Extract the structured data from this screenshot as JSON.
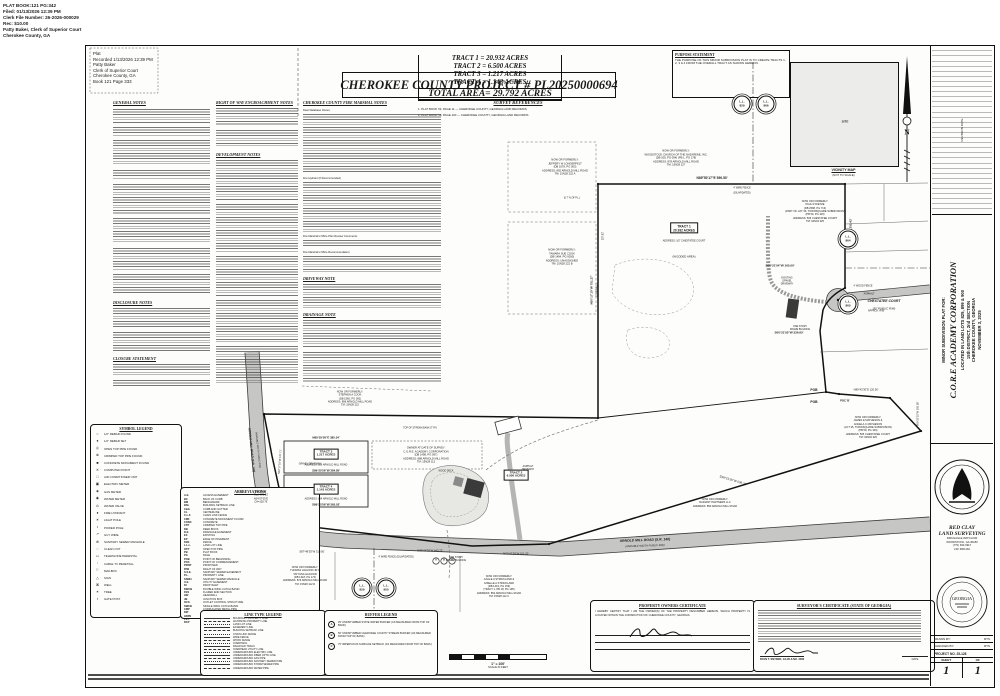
{
  "stamp": {
    "lines": [
      "PLAT BOOK:121  PG:342",
      "Filed: 01/13/2026 12:39 PM",
      "Clerk File Number: 26-2026-000029",
      "Rec: $10.00",
      "Patty Baker, Clerk of Superior Court",
      "Cherokee County, GA"
    ]
  },
  "recorded": {
    "lines": [
      "Plat",
      "Recorded 1/13/2026 12:39 PM",
      "Patty Baker",
      "Clerk of Superior Court",
      "Cherokee County, GA",
      "Book 121 Page 333"
    ]
  },
  "title": "CHEROKEE COUNTY PROJECT # PL20250000694",
  "survey_references": {
    "header": "SURVEY REFERENCES",
    "items": [
      "1.  PLAT BOOK 53, PAGE 11 — CHEROKEE COUNTY, GEORGIA LAND RECORDS",
      "2.  PLAT BOOK 59, PAGE 100 — CHEROKEE COUNTY, GEORGIA LAND RECORDS"
    ]
  },
  "tract_table": {
    "rows": [
      "TRACT 1 =   20.932 ACRES",
      "TRACT 2 =   6.500 ACRES",
      "TRACT 3 =   1.217 ACRES",
      "TRACT 4 =   1.143 ACRES"
    ],
    "total": "TOTAL AREA= 29.792 ACRES"
  },
  "purpose": {
    "header": "PURPOSE STATEMENT",
    "text": "THE PURPOSE OF THIS MINOR SUBDIVISION PLAT IS TO CREATE TRACTS 1, 2, 3 & 4 FROM THE OVERALL TRACT AS SHOWN HEREON."
  },
  "vicinity": {
    "caption": "VICINITY MAP",
    "subcaption": "(NOT TO SCALE)",
    "site_label": "SITE"
  },
  "north_label": "N",
  "notes": {
    "left_col_headers": [
      "GENERAL NOTES",
      "DISCLOSURE NOTES",
      "CLOSURE STATEMENT"
    ],
    "col1_headers": [
      "RIGHT OF WAY ENCROACHMENT NOTES",
      "DEVELOPMENT NOTES"
    ],
    "col2_headers": [
      "CHEROKEE COUNTY FIRE MARSHAL NOTES",
      "DRIVEWAY NOTE",
      "DRAINAGE NOTE"
    ],
    "col2_subheads": [
      "Dear Database Owner,",
      "Fire Hydrant (If Recommended)",
      "Fire Marshal's Office Plan Review Comments:",
      "Fire Marshal's Office Recommendation:"
    ]
  },
  "symbol_legend": {
    "header": "SYMBOL LEGEND",
    "items": [
      {
        "sym": "○",
        "label": "1/2\" REBAR FOUND"
      },
      {
        "sym": "●",
        "label": "1/2\" REBAR SET"
      },
      {
        "sym": "◎",
        "label": "OPEN TOP PIPE FOUND"
      },
      {
        "sym": "⊗",
        "label": "CRIMPED TOP PIPE FOUND"
      },
      {
        "sym": "■",
        "label": "CONCRETE MONUMENT FOUND"
      },
      {
        "sym": "✕",
        "label": "COMPUTED POINT"
      },
      {
        "sym": "□",
        "label": "AIR CONDITIONER UNIT"
      },
      {
        "sym": "▣",
        "label": "ELECTRIC METER"
      },
      {
        "sym": "◈",
        "label": "GAS METER"
      },
      {
        "sym": "◉",
        "label": "WATER METER"
      },
      {
        "sym": "⊙",
        "label": "WATER VALVE"
      },
      {
        "sym": "♦",
        "label": "FIRE HYDRANT"
      },
      {
        "sym": "☀",
        "label": "LIGHT POLE"
      },
      {
        "sym": "•",
        "label": "POWER POLE"
      },
      {
        "sym": "↗",
        "label": "GUY WIRE"
      },
      {
        "sym": "⊕",
        "label": "SANITARY SEWER MANHOLE"
      },
      {
        "sym": "◌",
        "label": "CLEAN OUT"
      },
      {
        "sym": "▭",
        "label": "TELEPHONE PEDESTAL"
      },
      {
        "sym": "▫",
        "label": "CABLE TV PEDESTAL"
      },
      {
        "sym": "⚐",
        "label": "MAILBOX"
      },
      {
        "sym": "△",
        "label": "SIGN"
      },
      {
        "sym": "⌘",
        "label": "WELL"
      },
      {
        "sym": "✶",
        "label": "TREE"
      },
      {
        "sym": "▪",
        "label": "GATE POST"
      }
    ]
  },
  "abbreviations": {
    "header": "ABBREVIATIONS",
    "items": [
      {
        "k": "A.E.",
        "v": "ACCESS EASEMENT"
      },
      {
        "k": "BC",
        "v": "BACK OF CURB"
      },
      {
        "k": "BM",
        "v": "BENCHMARK"
      },
      {
        "k": "BSL",
        "v": "BUILDING SETBACK LINE"
      },
      {
        "k": "C&G",
        "v": "CURB AND GUTTER"
      },
      {
        "k": "CL",
        "v": "CENTERLINE"
      },
      {
        "k": "C.L.F.",
        "v": "CHAIN LINK FENCE"
      },
      {
        "k": "CMF",
        "v": "CONCRETE MONUMENT FOUND"
      },
      {
        "k": "CONC",
        "v": "CONCRETE"
      },
      {
        "k": "CTP",
        "v": "CRIMPED TOP PIPE"
      },
      {
        "k": "DB",
        "v": "DEED BOOK"
      },
      {
        "k": "D.E.",
        "v": "DRAINAGE EASEMENT"
      },
      {
        "k": "EX",
        "v": "EXISTING"
      },
      {
        "k": "EP",
        "v": "EDGE OF PAVEMENT"
      },
      {
        "k": "FEN",
        "v": "FENCE"
      },
      {
        "k": "L.L.L.",
        "v": "LAND LOT LINE"
      },
      {
        "k": "OTP",
        "v": "OPEN TOP PIPE"
      },
      {
        "k": "PB",
        "v": "PLAT BOOK"
      },
      {
        "k": "PG",
        "v": "PAGE"
      },
      {
        "k": "POB",
        "v": "POINT OF BEGINNING"
      },
      {
        "k": "POC",
        "v": "POINT OF COMMENCEMENT"
      },
      {
        "k": "PROP",
        "v": "PROPOSED"
      },
      {
        "k": "R/W",
        "v": "RIGHT OF WAY"
      },
      {
        "k": "S.S.E.",
        "v": "SANITARY SEWER EASEMENT"
      },
      {
        "k": "P.L.",
        "v": "PROPERTY LINE"
      },
      {
        "k": "SSMH",
        "v": "SANITARY SEWER MANHOLE"
      },
      {
        "k": "U.E.",
        "v": "UTILITY EASEMENT"
      },
      {
        "k": "DI",
        "v": "DROP INLET"
      },
      {
        "k": "DWCB",
        "v": "DOUBLE WING CATCH BASIN"
      },
      {
        "k": "FES",
        "v": "FLARED END SECTION"
      },
      {
        "k": "HW",
        "v": "HEADWALL"
      },
      {
        "k": "JB",
        "v": "JUNCTION BOX"
      },
      {
        "k": "OCS",
        "v": "OUTLET CONTROL STRUCTURE"
      },
      {
        "k": "SWCB",
        "v": "SINGLE WING CATCH BASIN"
      },
      {
        "k": "CMP",
        "v": "CORRUGATED METAL PIPE"
      },
      {
        "k": "DIP",
        "v": "DUCTILE IRON PIPE"
      },
      {
        "k": "HDPE",
        "v": "HIGH DENSITY POLYETHYLENE PIPE"
      },
      {
        "k": "PVC",
        "v": "POLYVINYL CHLORIDE PIPE"
      },
      {
        "k": "RCP",
        "v": "REINFORCED CONCRETE PIPE"
      }
    ]
  },
  "linetype_legend": {
    "header": "LINE TYPE LEGEND",
    "items": [
      "BOUNDARY PROPERTY LINE",
      "ADJOINING PROPERTY LINE",
      "LAND LOT LINE",
      "EASEMENT LINE",
      "BUILDING SETBACK LINE",
      "CHAIN LINK FENCE",
      "WIRE FENCE",
      "WOOD FENCE",
      "OVERHANG",
      "RAILROAD TRACK",
      "OVERHEAD UTILITY LINE",
      "UNDERGROUND ELECTRIC LINE",
      "UNDERGROUND FIBER OPTIC LINE",
      "UNDERGROUND GAS PIPE",
      "UNDERGROUND SANITARY SEWER PIPE",
      "UNDERGROUND STORM SEWER PIPE",
      "UNDERGROUND WATER PIPE"
    ]
  },
  "buffer_legend": {
    "header": "BUFFER LEGEND",
    "items": [
      {
        "k": "A",
        "v": "25' UNDISTURBED STATE WATER BUFFER (AS MEASURED FROM TOP OF BANK)"
      },
      {
        "k": "B",
        "v": "50' UNDISTURBED CHEROKEE COUNTY STREAM BUFFER (AS MEASURED FROM TOP OF BANK)"
      },
      {
        "k": "C",
        "v": "75' IMPERVIOUS SURFACE SETBACK (AS MEASURED FROM TOP OF BANK)"
      }
    ]
  },
  "scale_bar": {
    "text": "1\" = 100'",
    "sub": "SCALE IN FEET"
  },
  "owner_cert": {
    "header": "PROPERTY OWNERS CERTIFICATE",
    "body": "I HEREBY CERTIFY THAT I AM THE OWNER(S) OF THE PROPERTY DESCRIBED HEREON, WHICH PROPERTY IS LOCATED WITHIN THE JURISDICTION OF CHEROKEE COUNTY, GEORGIA.",
    "fields": [
      "SIGNATURE",
      "PRINTED NAME:",
      "DATE:"
    ]
  },
  "surveyor_cert": {
    "header": "SURVEYOR'S CERTIFICATE (STATE OF GEORGIA)",
    "signer": "RYAN T. SNYDER, GA RLS NO. 3382",
    "date_label": "DATE"
  },
  "titleblock": {
    "revisions_label": "REVISION          DATE",
    "plat_for": "MINOR SUBDIVISION PLAT FOR:",
    "client": "C.O.R.E ACADEMY CORPORATION",
    "loc1": "LOCATED IN LAND LOTS 829, 899 & 900",
    "loc2": "15th DISTRICT, 2nd SECTION",
    "loc3": "CHEROKEE COUNTY, GEORGIA",
    "date": "NOVEMBER 3, 2025",
    "firm1": "RED CLAY",
    "firm2": "LAND SURVEYING",
    "addr1": "3309 EAGLE WATCH DR",
    "addr2": "WOODSTOCK, GA 30189",
    "phone": "(770) 630-6917",
    "lsf": "LSF #001162",
    "drawn_label": "DRAWN BY:",
    "drawn": "RTS",
    "checked_label": "CHECKED BY:",
    "checked": "RTS",
    "project_label": "PROJECT NO.",
    "project": "25-128",
    "sheet_label": "SHEET",
    "of_label": "OF",
    "sheet": "1",
    "of": "1",
    "seal_text": "GEORGIA"
  },
  "map": {
    "labels": [
      {
        "t": "N89°50'17\"E  590.50'",
        "x": 712,
        "y": 179,
        "s": 3.3,
        "b": 1
      },
      {
        "t": "S00°42'35\"W  252.42'",
        "x": 851,
        "y": 233,
        "s": 3,
        "b": 1,
        "r": -90
      },
      {
        "t": "S00°21'04\"W  165.00'",
        "x": 780,
        "y": 266,
        "s": 3,
        "b": 1
      },
      {
        "t": "S00°21'05\"W  326.65'",
        "x": 789,
        "y": 333,
        "s": 3,
        "b": 1
      },
      {
        "t": "N89°42'30\"E 120.50'",
        "x": 866,
        "y": 390,
        "s": 2.7
      },
      {
        "t": "POC 'B'",
        "x": 845,
        "y": 401,
        "s": 2.7,
        "b": 1
      },
      {
        "t": "S00°31'15\"W 105.56'",
        "x": 919,
        "y": 414,
        "s": 2.6,
        "r": -90
      },
      {
        "t": "POB",
        "x": 814,
        "y": 391,
        "s": 3.3,
        "b": 1
      },
      {
        "t": "POB",
        "x": 814,
        "y": 403,
        "s": 3.3,
        "b": 1
      },
      {
        "t": "S48°21'35\"W  509.32'",
        "x": 733,
        "y": 481,
        "s": 3,
        "r": 17
      },
      {
        "t": "N62°42'38\"W 101.20'",
        "x": 516,
        "y": 554,
        "s": 2.7
      },
      {
        "t": "N89°44'39\"W  443.72'",
        "x": 430,
        "y": 551,
        "s": 2.7
      },
      {
        "t": "S87°48'35\"W  310.50'",
        "x": 312,
        "y": 552,
        "s": 2.7
      },
      {
        "t": "N89°25'56\"E  385.34'",
        "x": 326,
        "y": 437.5,
        "s": 2.9,
        "b": 1
      },
      {
        "t": "S89°25'56\"W  384.85'",
        "x": 326,
        "y": 471,
        "s": 2.9,
        "b": 1
      },
      {
        "t": "S89°25'56\"W  365.02'",
        "x": 326,
        "y": 504.5,
        "s": 2.9,
        "b": 1
      },
      {
        "t": "N00°17'10\"W 137.71'",
        "x": 281,
        "y": 462,
        "s": 2.6,
        "r": -86
      },
      {
        "t": "N00°17'10\"W  751.27'",
        "x": 592,
        "y": 290,
        "s": 3,
        "b": 1,
        "r": -90
      },
      {
        "t": "(OVERALL)",
        "x": 598,
        "y": 290,
        "s": 2.6,
        "r": -90
      },
      {
        "t": "287.82'",
        "x": 604,
        "y": 236,
        "s": 2.5,
        "r": -90
      },
      {
        "t": "(0.7' N OF P.L.)",
        "x": 572,
        "y": 199,
        "s": 2.4
      },
      {
        "t": "4' WOOD FENCE",
        "x": 863,
        "y": 287,
        "s": 2.4
      },
      {
        "t": "ASPHALT",
        "x": 869,
        "y": 295,
        "s": 2.4
      },
      {
        "t": "APPROX. R/W",
        "x": 876,
        "y": 312,
        "s": 2.4
      },
      {
        "t": "CHESTATEE COURT",
        "x": 884,
        "y": 302,
        "s": 3.4,
        "b": 1,
        "i": 1
      },
      {
        "t": "(50' PUBLIC R/W)",
        "x": 884,
        "y": 309,
        "s": 2.8,
        "i": 1
      },
      {
        "t": "GRAVEL DRIVEWAY",
        "x": 310,
        "y": 465,
        "s": 2.4
      },
      {
        "t": "WOOD DECK",
        "x": 446,
        "y": 472,
        "s": 2.4
      },
      {
        "t": "TOP OF STREAM BANK (TYP.)",
        "x": 420,
        "y": 429,
        "s": 2.4
      },
      {
        "t": "4' WIRE FENCE (DILAPIDATED)",
        "x": 396,
        "y": 558,
        "s": 2.4
      },
      {
        "t": "4' WIRE FENCE",
        "x": 742,
        "y": 189,
        "s": 2.4
      },
      {
        "t": "(DILAPIDATED)",
        "x": 742,
        "y": 194,
        "s": 2.4
      },
      {
        "t": "ARNOLD MILL ROAD  (S.R. 140)",
        "x": 645,
        "y": 541,
        "s": 3.4,
        "b": 1,
        "i": 1,
        "r": -2
      },
      {
        "t": "(VARIABLE WIDTH PUBLIC R/W)",
        "x": 645,
        "y": 547,
        "s": 2.6,
        "i": 1,
        "r": -2
      },
      {
        "t": "ARNOLD MILL ROAD (S.R. 140)",
        "x": 251,
        "y": 450,
        "s": 3,
        "b": 1,
        "i": 1,
        "r": 84
      },
      {
        "t": "(VARIABLE WIDTH PUBLIC R/W)",
        "x": 257,
        "y": 450,
        "s": 2.4,
        "i": 1,
        "r": 84
      },
      {
        "t": "A",
        "x": 436,
        "y": 561,
        "s": 2.4,
        "b": 1
      },
      {
        "t": "B",
        "x": 444,
        "y": 561,
        "s": 2.4,
        "b": 1
      },
      {
        "t": "C",
        "x": 452,
        "y": 561,
        "s": 2.4,
        "b": 1
      },
      {
        "t": "N",
        "x": 907,
        "y": 133,
        "s": 7.5,
        "b": 1,
        "f": "serif"
      },
      {
        "t": "(WOODED AREA)",
        "x": 684,
        "y": 257,
        "s": 2.8
      }
    ],
    "blocks": [
      {
        "x": 565,
        "y": 167,
        "s": 2.7,
        "lines": [
          "NOW OR FORMERLY:",
          "JEFFERY W LONGERFELT",
          "(DB 1678, PG 003)",
          "ADDRESS: 892 ARNOLD MILL ROAD",
          "TM: 15N28 222 A"
        ]
      },
      {
        "x": 676,
        "y": 158,
        "s": 2.7,
        "lines": [
          "NOW OR FORMERLY:",
          "WOODSTOCK CHURCH OF THE NAZARENE, INC.",
          "(DB 505, PG 094)  (PB 1, PG 178)",
          "ADDRESS: 878 ARNOLD MILL ROAD",
          "TM: 15N28 227"
        ]
      },
      {
        "x": 815,
        "y": 212,
        "s": 2.6,
        "lines": [
          "NOW OR FORMERLY:",
          "PAUL R DIETZE",
          "(DB 2598, PG 713)",
          "(PART OF LOT 36, TOWNSQUARE SUBDIVISION)",
          "(PB 59, PG 100)",
          "ADDRESS: 506 CHESTATEE COURT",
          "TM: 02N04 325"
        ]
      },
      {
        "x": 562,
        "y": 257,
        "s": 2.7,
        "lines": [
          "NOW OR FORMERLY:",
          "TAMARA SUE COOK",
          "(DB 1494, PG 0050)",
          "ADDRESS: UNASSIGNED",
          "TM: 15N28 222 B"
        ]
      },
      {
        "x": 868,
        "y": 428,
        "s": 2.6,
        "lines": [
          "NOW OR FORMERLY:",
          "JAMES E MATHESON &",
          "ANGELA C MATHESON",
          "(LOT 35, TOWNSQUARE SUBDIVISION)",
          "(PB 59, PG 100)",
          "ADDRESS: 505 CHESTATEE COURT",
          "TM: 02N04 326"
        ]
      },
      {
        "x": 350,
        "y": 399,
        "s": 2.6,
        "lines": [
          "NOW OR FORMERLY:",
          "STEPHEN A COOK",
          "(DB 1565, PG 092)",
          "ADDRESS: 896 ARNOLD MILL ROAD",
          "TM: 15N28 222"
        ]
      },
      {
        "x": 426,
        "y": 455,
        "s": 2.7,
        "lines": [
          "OWNER AT DATE OF SURVEY:",
          "C.O.R.E. ACADEMY CORPORATION",
          "(DB 1498, PG 097)",
          "ADDRESS: 888 ARNOLD MILL ROAD",
          "TM: 15N28 112"
        ]
      },
      {
        "x": 715,
        "y": 503,
        "s": 2.6,
        "lines": [
          "NOW OR FORMERLY:",
          "RADIANT PARTNERS LLC",
          "ADDRESS: 850 ARNOLD MILL ROAD"
        ]
      },
      {
        "x": 305,
        "y": 576,
        "s": 2.6,
        "lines": [
          "NOW OR FORMERLY:",
          "THOMAS HAGOOD JR &",
          "TATYANA HAGOOD",
          "(DB 1318, PG 174)",
          "ADDRESS: 876 ARNOLD MILL ROAD",
          "TM: 15N28 112 D"
        ]
      },
      {
        "x": 499,
        "y": 587,
        "s": 2.6,
        "lines": [
          "NOW OR FORMERLY:",
          "CAGLE A STRICKLAND &",
          "GISELLE A STRICKLAND",
          "(DB 1419, PG 159)",
          "(TRACT 1, PB 18, PG 195)",
          "ADDRESS: 852 ARNOLD MILL ROAD",
          "TM: 15N28 112 C"
        ]
      },
      {
        "x": 261,
        "y": 497,
        "s": 2.5,
        "lines": [
          "A=128.96'",
          "Rad=676.23'",
          "N04°57'05\"E",
          "CH=128.76'"
        ]
      },
      {
        "x": 787,
        "y": 281,
        "s": 2.4,
        "lines": [
          "EXISTING",
          "GRAVEL",
          "DRIVEWAY"
        ]
      },
      {
        "x": 800,
        "y": 328,
        "s": 2.4,
        "lines": [
          "ONE STORY",
          "FRAME BUILDING"
        ]
      },
      {
        "x": 456,
        "y": 559,
        "s": 2.4,
        "lines": [
          "ONE STORY",
          "FRAME BUILDING"
        ]
      },
      {
        "x": 528,
        "y": 468,
        "s": 2.4,
        "lines": [
          "ASPHALT",
          "DRIVEWAY"
        ]
      }
    ],
    "tracts": [
      {
        "x": 684,
        "y": 228,
        "s": 3.2,
        "lines": [
          "TRACT 1",
          "20.932 ACRES"
        ],
        "sub": "ADDRESS: 107 CHESTATEE COURT",
        "sx": 684,
        "sy": 242
      },
      {
        "x": 516,
        "y": 475,
        "s": 3,
        "lines": [
          "TRACT 2",
          "6.500 ACRES"
        ],
        "sub": "",
        "sx": 0,
        "sy": 0
      },
      {
        "x": 326,
        "y": 454,
        "s": 3,
        "lines": [
          "TRACT 3",
          "1.217 ACRES"
        ],
        "sub": "ADDRESS: 886 ARNOLD MILL ROAD",
        "sx": 326,
        "sy": 466
      },
      {
        "x": 326,
        "y": 489,
        "s": 3,
        "lines": [
          "TRACT 4",
          "1.143 ACRES"
        ],
        "sub": "ADDRESS: 884 ARNOLD MILL ROAD",
        "sx": 326,
        "sy": 499.5
      }
    ],
    "land_lots": [
      {
        "x": 742,
        "y": 104,
        "n": "829"
      },
      {
        "x": 766,
        "y": 104,
        "n": "866"
      },
      {
        "x": 848,
        "y": 239,
        "n": "864"
      },
      {
        "x": 848,
        "y": 304,
        "n": "865"
      },
      {
        "x": 362,
        "y": 588,
        "n": "829"
      },
      {
        "x": 386,
        "y": 588,
        "n": "900"
      }
    ]
  }
}
